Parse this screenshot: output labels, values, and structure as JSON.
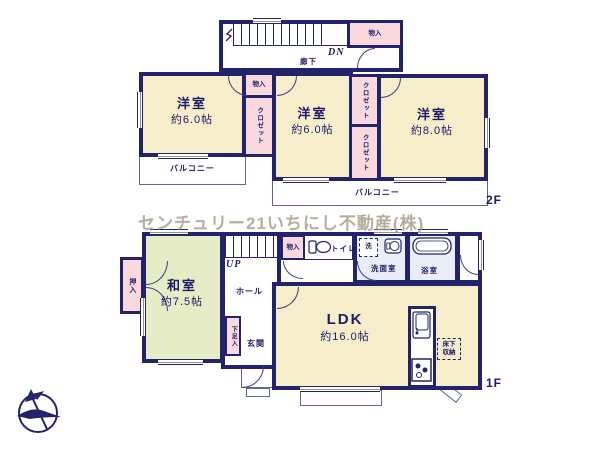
{
  "watermark": "センチュリー21いちにし不動産(株)",
  "floor2": {
    "label": "2F",
    "corridor": "廊下",
    "stairs_direction": "DN",
    "hall_storage": "物入",
    "room_storage": "物入",
    "closet_center": "クロゼット",
    "closet_right_top": "クロゼット",
    "closet_right_bottom": "クロゼット",
    "room_west_left": {
      "name": "洋室",
      "size": "約6.0帖"
    },
    "room_west_center": {
      "name": "洋室",
      "size": "約6.0帖"
    },
    "room_west_right": {
      "name": "洋室",
      "size": "約8.0帖"
    },
    "balcony_left": "バルコニー",
    "balcony_main": "バルコニー"
  },
  "floor1": {
    "label": "1F",
    "stairs_direction": "UP",
    "hall_storage": "物入",
    "toilet": "トイレ",
    "laundry": "洗",
    "washroom": "洗面室",
    "bathroom": "浴室",
    "tatami_room": {
      "name": "和室",
      "size": "約7.5帖"
    },
    "oshiire": "押入",
    "hall": "ホール",
    "entrance": "玄関",
    "shoe_cabinet": "下足入",
    "ldk": {
      "name": "LDK",
      "size": "約16.0帖"
    },
    "underfloor_storage": "床下収納"
  },
  "colors": {
    "wall": "#23236b",
    "western_room": "#f6edca",
    "tatami_room": "#e6ecc5",
    "closet": "#f9d9de",
    "wet_area": "#e9edf5",
    "watermark": "#b3a896"
  }
}
